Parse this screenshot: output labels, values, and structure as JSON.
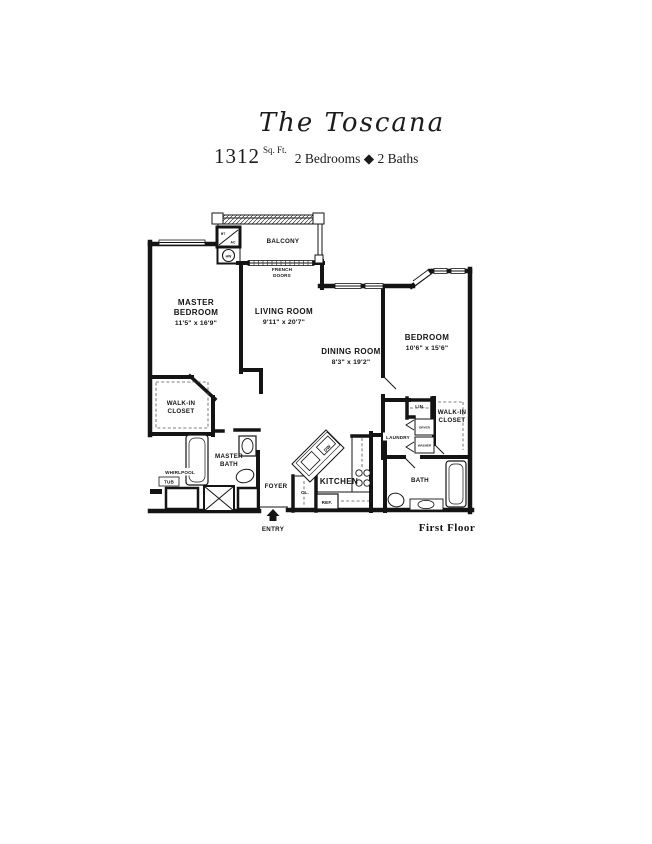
{
  "header": {
    "title": "The Toscana",
    "sqft": "1312",
    "sqft_unit": "Sq. Ft.",
    "specs": "2 Bedrooms ◆ 2 Baths"
  },
  "plan": {
    "rooms": {
      "master_bedroom": {
        "line1": "MASTER",
        "line2": "BEDROOM",
        "dims": "11'5\" x 16'9\""
      },
      "living_room": {
        "line1": "LIVING ROOM",
        "dims": "9'11\" x 20'7\""
      },
      "dining_room": {
        "line1": "DINING ROOM",
        "dims": "8'3\" x 19'2\""
      },
      "bedroom": {
        "line1": "BEDROOM",
        "dims": "10'6\" x 15'6\""
      }
    },
    "labels": {
      "balcony": "BALCONY",
      "french_doors_line1": "FRENCH",
      "french_doors_line2": "DOORS",
      "ht": "HT",
      "ac": "AC",
      "hw": "HW",
      "walkin_master_line1": "WALK-IN",
      "walkin_master_line2": "CLOSET",
      "master_bath_line1": "MASTER",
      "master_bath_line2": "BATH",
      "whirlpool_line1": "WHIRLPOOL",
      "whirlpool_line2": "TUB",
      "foyer": "FOYER",
      "closet": "CL.",
      "entry": "ENTRY",
      "kitchen": "KITCHEN",
      "dishwasher": "DW",
      "refrigerator": "REF.",
      "laundry": "LAUNDRY",
      "linen": "LIN.",
      "dryer": "DRYER",
      "washer": "WASHER",
      "walkin2_line1": "WALK-IN",
      "walkin2_line2": "CLOSET",
      "bath": "BATH"
    },
    "footer": "First Floor"
  },
  "colors": {
    "ink": "#141414",
    "paper": "#ffffff"
  }
}
